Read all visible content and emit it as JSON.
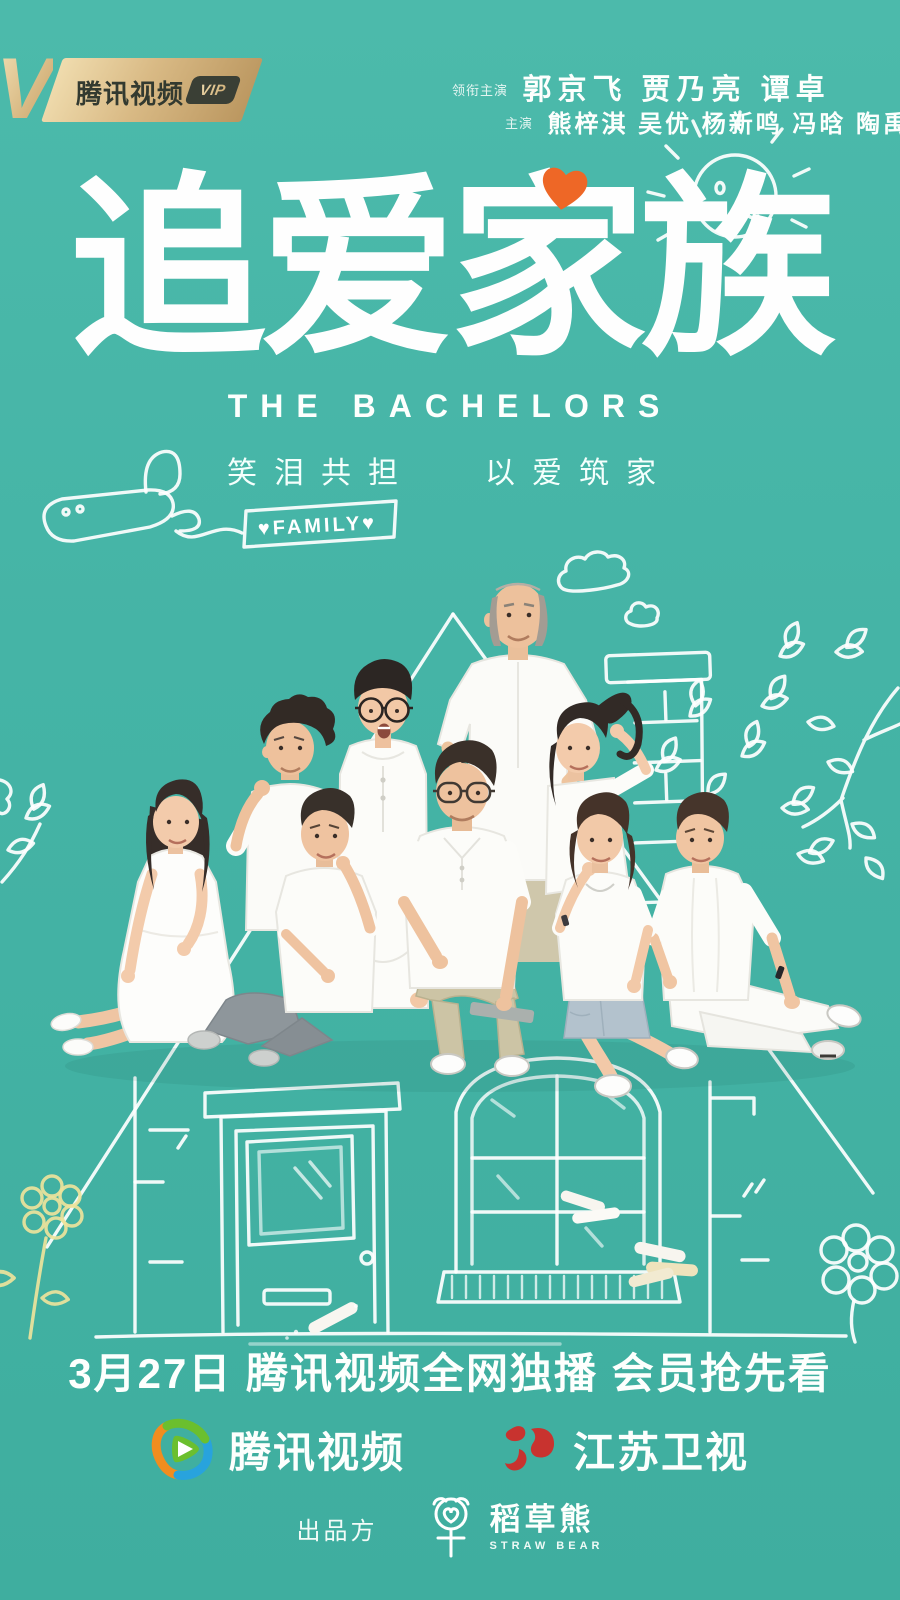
{
  "vip_badge": {
    "v": "V",
    "brand": "腾讯视频",
    "vip": "VIP"
  },
  "credits": {
    "lead_label": "领衔主演",
    "lead_names": "郭京飞 贾乃亮 谭卓",
    "co_label": "主演",
    "co_names": "熊梓淇 吴优 杨新鸣 冯晗 陶禹佑 杨雨潼"
  },
  "title": {
    "zh": "追爱家族",
    "en": "THE BACHELORS"
  },
  "tagline": {
    "left": "笑泪共担",
    "right": "以爱筑家"
  },
  "banner": {
    "text": "♥FAMILY♥"
  },
  "release": {
    "text": "3月27日 腾讯视频全网独播 会员抢先看"
  },
  "networks": [
    {
      "name": "腾讯视频"
    },
    {
      "name": "江苏卫视"
    }
  ],
  "producer": {
    "label": "出品方",
    "name_zh": "稻草熊",
    "name_en": "STRAW BEAR"
  },
  "colors": {
    "background": "#45b4a6",
    "doodle_white": "#ffffff",
    "heart_orange": "#ee6726",
    "badge_gold": "#d9ba85",
    "badge_dark": "#3a3f35",
    "jiangsu_red": "#c8332f",
    "tencent_orange": "#f18d1f",
    "tencent_green": "#6bbf2e",
    "tencent_blue": "#28a3dd",
    "flower_yellow": "#ede39b"
  }
}
